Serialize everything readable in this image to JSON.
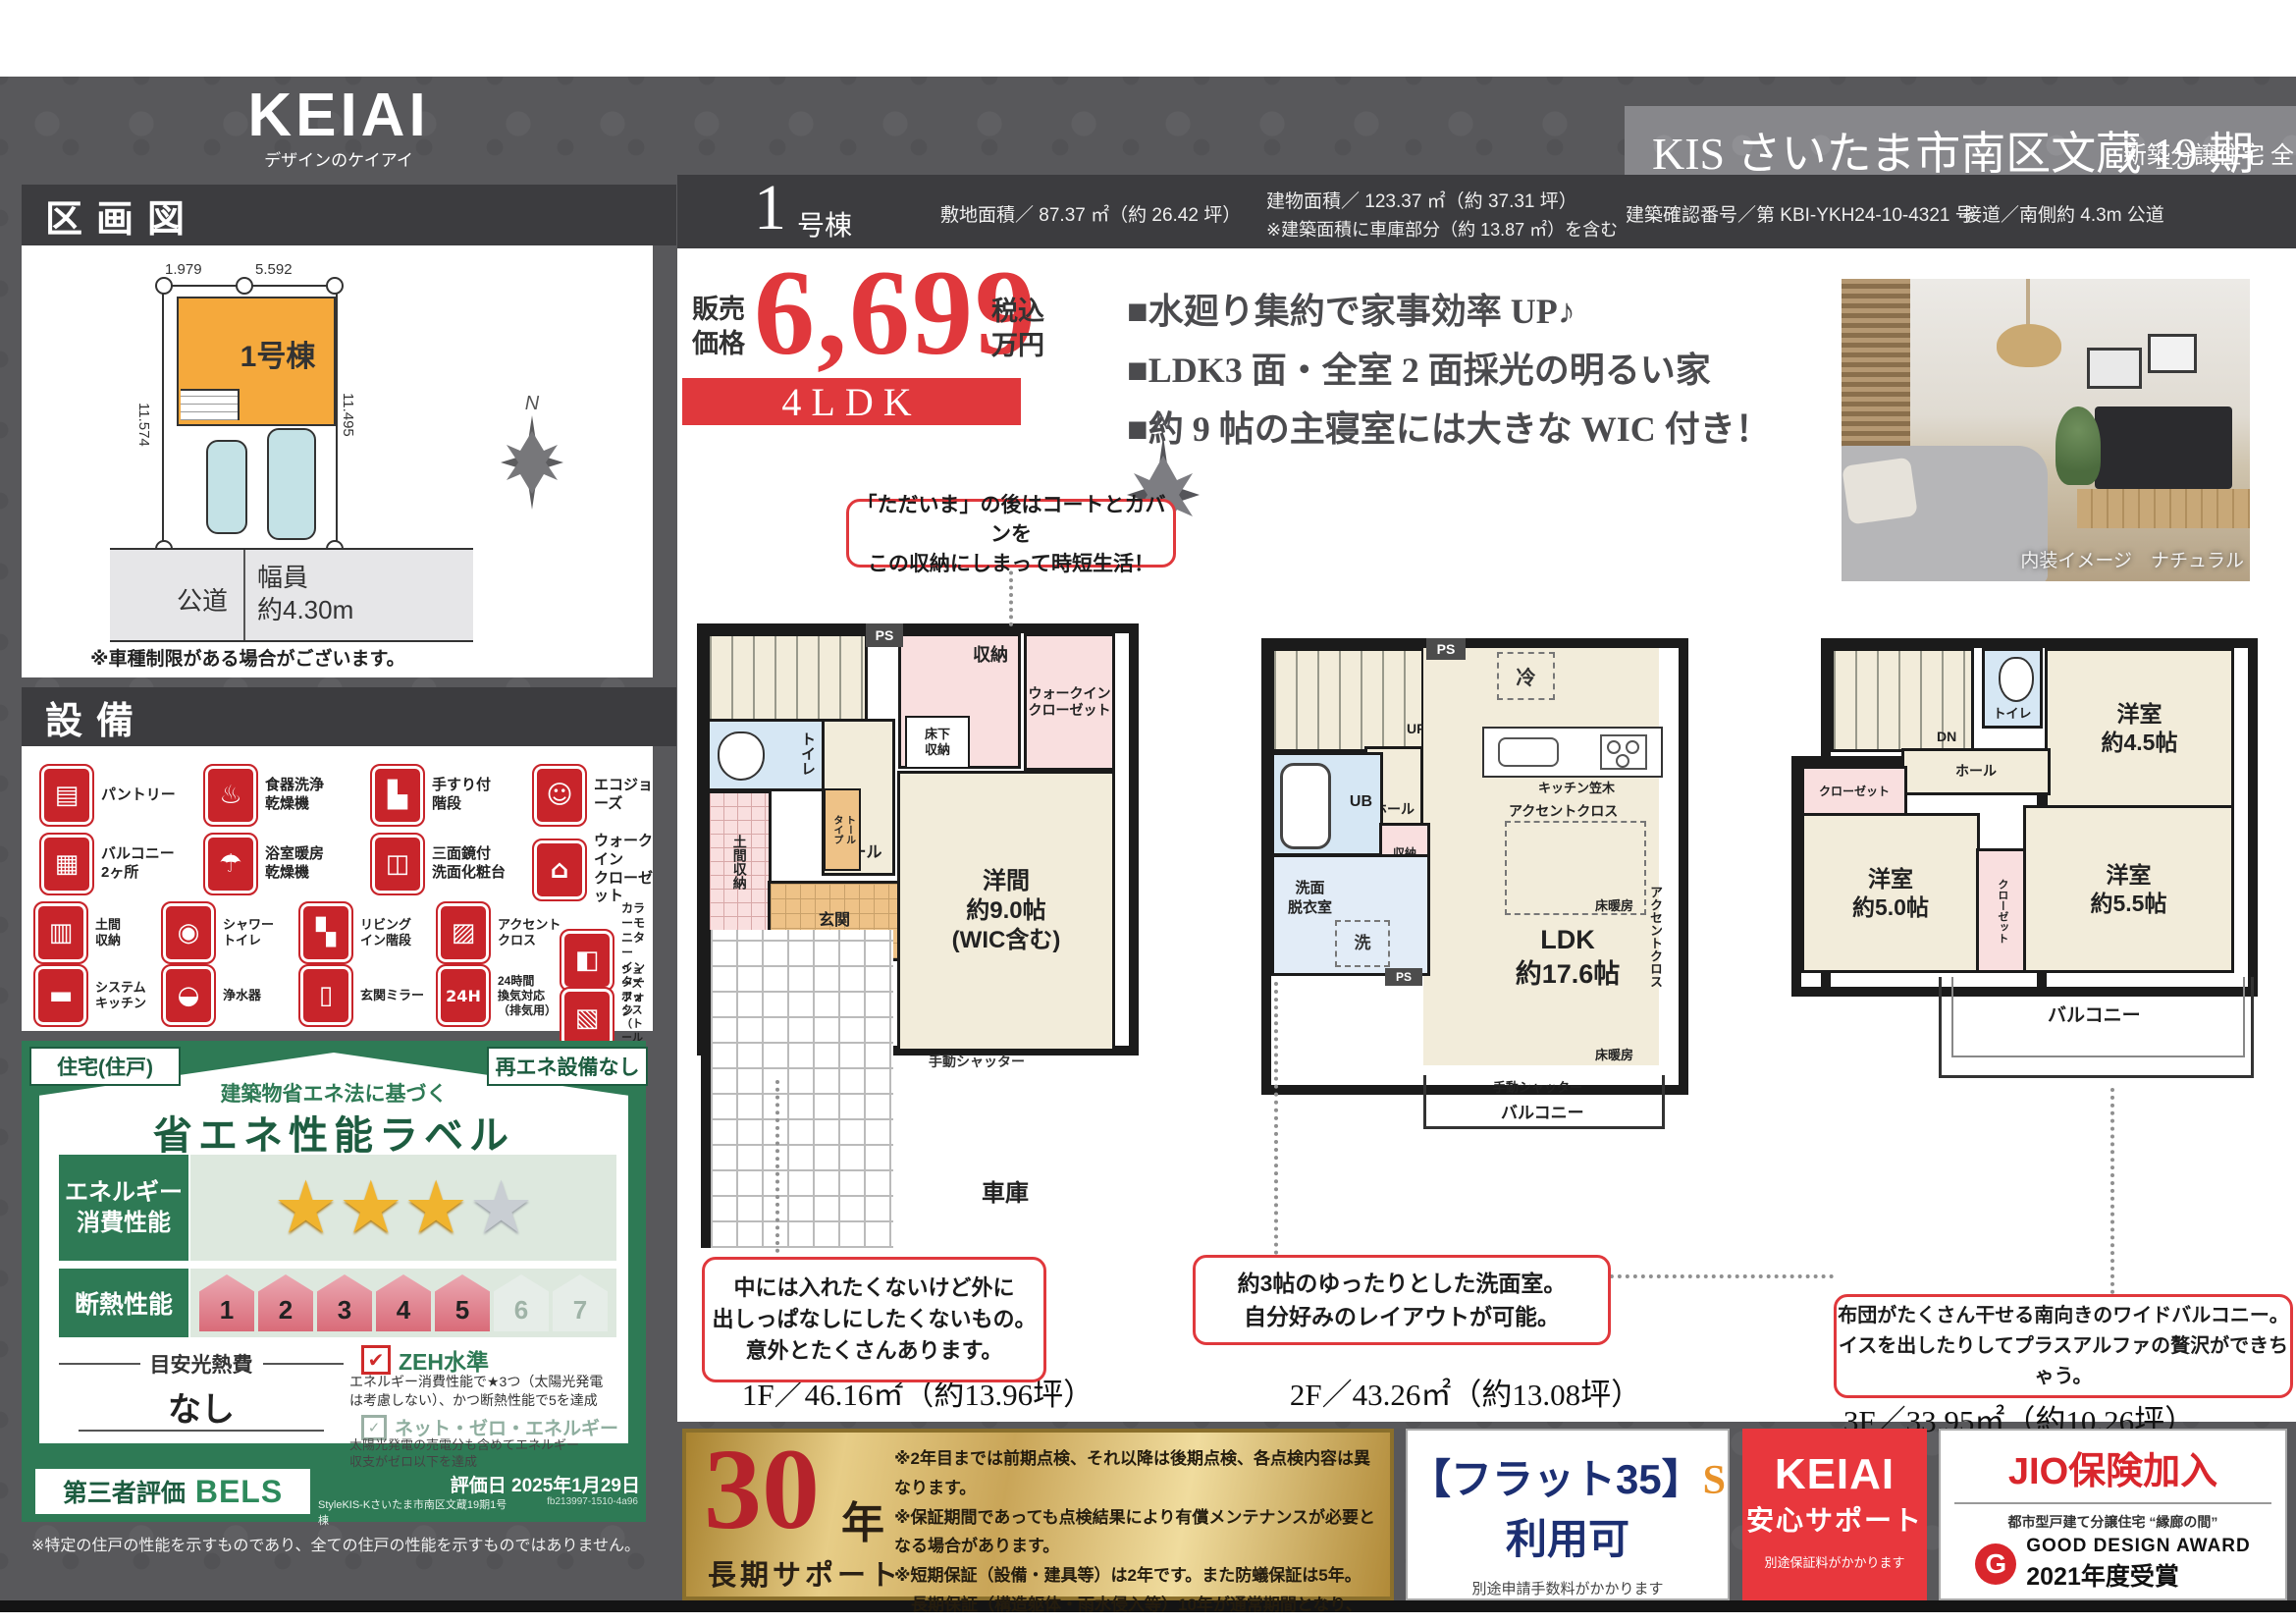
{
  "brand": {
    "logo": "KEIAI",
    "tagline": "デザインのケイアイ"
  },
  "header": {
    "title": "KIS さいたま市南区文蔵 19 期",
    "subtitle": "新築分譲住宅 全 1 棟"
  },
  "info_bar": {
    "unit_no": "1",
    "unit_suffix": "号棟",
    "land_area": "敷地面積／ 87.37 ㎡（約 26.42 坪）",
    "building_area": "建物面積／ 123.37 ㎡（約 37.31 坪）",
    "building_note": "※建築面積に車庫部分（約 13.87 ㎡）を含む",
    "confirmation": "建築確認番号／第 KBI-YKH24-10-4321 号",
    "road": "接道／南側約 4.3m 公道"
  },
  "price": {
    "label": "販売\n価格",
    "value": "6,699",
    "tax": "税込\n万円",
    "plan_type": "4LDK"
  },
  "features": [
    "■水廻り集約で家事効率 UP♪",
    "■LDK3 面・全室 2 面採光の明るい家",
    "■約 9 帖の主寝室には大きな WIC 付き！"
  ],
  "photo": {
    "caption": "内装イメージ　ナチュラル"
  },
  "compass": {
    "n": "N"
  },
  "plot_map": {
    "title": "区画図",
    "unit_label": "1号棟",
    "dims": {
      "top_left": "1.979",
      "top_right": "5.592",
      "right": "11.495",
      "left": "11.574",
      "bottom": "7.578"
    },
    "road_name": "公道",
    "road_width": "幅員\n約4.30m",
    "note": "※車種制限がある場合がございます。",
    "compass_n": "N"
  },
  "equipment": {
    "title": "設備",
    "items": [
      {
        "glyph": "▤",
        "label": "パントリー"
      },
      {
        "glyph": "♨",
        "label": "食器洗浄\n乾燥機"
      },
      {
        "glyph": "▙",
        "label": "手すり付\n階段"
      },
      {
        "glyph": "☺",
        "label": "エコジョーズ"
      },
      {
        "glyph": "▦",
        "label": "バルコニー\n2ヶ所"
      },
      {
        "glyph": "☂",
        "label": "浴室暖房\n乾燥機"
      },
      {
        "glyph": "◫",
        "label": "三面鏡付\n洗面化粧台"
      },
      {
        "glyph": "⌂",
        "label": "ウォークイン\nクローゼット"
      },
      {
        "glyph": "▥",
        "label": "土間\n収納"
      },
      {
        "glyph": "◉",
        "label": "シャワー\nトイレ"
      },
      {
        "glyph": "▚",
        "label": "リビング\nイン階段"
      },
      {
        "glyph": "▨",
        "label": "アクセント\nクロス"
      },
      {
        "glyph": "◧",
        "label": "カラーモニター\nインターフォン"
      },
      {
        "glyph": "▬",
        "label": "システム\nキッチン"
      },
      {
        "glyph": "◒",
        "label": "浄水器"
      },
      {
        "glyph": "▯",
        "label": "玄関ミラー"
      },
      {
        "glyph": "24H",
        "label": "24時間\n換気対応\n（排気用）"
      },
      {
        "glyph": "▧",
        "label": "シューズボックス\n（トールタイプ）"
      }
    ]
  },
  "energy": {
    "badge_left": "住宅(住戸)",
    "badge_right": "再エネ設備なし",
    "subtitle": "建築物省エネ法に基づく",
    "title": "省エネ性能ラベル",
    "row_energy": "エネルギー\n消費性能",
    "row_insulation": "断熱性能",
    "stars_on": "★★★",
    "star_off": "★",
    "levels": [
      "1",
      "2",
      "3",
      "4",
      "5",
      "6",
      "7"
    ],
    "cost_label": "目安光熱費",
    "cost_value": "なし",
    "zeh_title": "ZEH水準",
    "zeh_desc": "エネルギー消費性能で★3つ（太陽光発電\nは考慮しない）、かつ断熱性能で5を達成",
    "nze_title": "ネット・ゼロ・エネルギー",
    "nze_desc": "太陽光発電の売電分も含めてエネルギー\n収支がゼロ以下を達成",
    "bels_prefix": "第三者評価",
    "bels": "BELS",
    "bels_name": "StyleKIS-Kさいたま市南区文蔵19期1号棟",
    "eval_date": "評価日 2025年1月29日",
    "eval_code": "fb213997-1510-4a96",
    "footnote": "※特定の住戸の性能を示すものであり、全ての住戸の性能を示すものではありません。"
  },
  "floors": {
    "f1": {
      "area": "1F／46.16㎡（約13.96坪）",
      "callout_top": "「ただいま」の後はコートとカバンを\nこの収納にしまって時短生活！",
      "callout_bottom": "中には入れたくないけど外に\n出しっぱなしにしたくないもの。\n意外とたくさんあります。",
      "rooms": {
        "ps": "PS",
        "storage": "収納",
        "wic": "ウォークイン\nクローゼット",
        "underfloor": "床下\n収納",
        "toilet": "トイレ",
        "up": "UP",
        "hall": "ホール",
        "tall": "トール\nタイプ",
        "doma": "土間収納",
        "entrance": "玄関",
        "main": "洋間\n約9.0帖\n(WIC含む)",
        "shutter": "手動シャッター",
        "garage": "車庫"
      }
    },
    "f2": {
      "area": "2F／43.26㎡（約13.08坪）",
      "callout": "約3帖のゆったりとした洗面室。\n自分好みのレイアウトが可能。",
      "rooms": {
        "ps_top": "PS",
        "fridge": "冷",
        "up": "UP",
        "dn": "DN",
        "hall": "ホール",
        "ub": "UB",
        "storage": "収納",
        "wash": "洗面\n脱衣室",
        "washer": "洗",
        "ps_bottom": "PS",
        "kitchen": "キッチン笠木",
        "accent_top": "アクセントクロス",
        "accent_right": "アクセントクロス",
        "ldk": "LDK\n約17.6帖",
        "heat1": "床暖房",
        "heat2": "床暖房",
        "shutter": "手動シャッター",
        "balcony": "バルコニー"
      }
    },
    "f3": {
      "area": "3F／33.95㎡（約10.26坪）",
      "callout": "布団がたくさん干せる南向きのワイドバルコニー。\nイスを出したりしてプラスアルファの贅沢ができちゃう。",
      "rooms": {
        "dn": "DN",
        "toilet": "トイレ",
        "hall": "ホール",
        "closet_l": "クローゼット",
        "r45": "洋室\n約4.5帖",
        "r50": "洋室\n約5.0帖",
        "closet_c": "クローゼット",
        "r55": "洋室\n約5.5帖",
        "balcony": "バルコニー"
      }
    }
  },
  "banners": {
    "support": {
      "big": "30",
      "unit": "年",
      "label": "長期サポート",
      "notes": [
        "※2年目までは前期点検、それ以降は後期点検、各点検内容は異なります。",
        "※保証期間であっても点検結果により有償メンテナンスが必要となる場合があります。",
        "※短期保証（設備・建具等）は2年です。また防蟻保証は5年。",
        "長期保証（構造躯体・雨水侵入等）10年が通常期間となり、",
        "それ以降の後期保証の延長には当社が指定する条件を満たす必要があります。"
      ]
    },
    "flat35": {
      "line1": "【フラット35】",
      "s": "S",
      "line2": "利用可",
      "note": "別途申請手数料がかかります"
    },
    "keiai": {
      "brand": "KEIAI",
      "label": "安心サポート",
      "note": "別途保証料がかかります"
    },
    "jio": {
      "title": "JIO保険加入",
      "gda_sub": "都市型戸建て分譲住宅 “縁廊の間”",
      "gda_mark": "G",
      "gda_line1": "GOOD DESIGN AWARD",
      "gda_line2": "2021年度受賞"
    }
  },
  "colors": {
    "accent_red": "#d92b30",
    "brand_green": "#2e7a55",
    "gold": "#c9a558",
    "dark_band": "#3c3c3f"
  }
}
